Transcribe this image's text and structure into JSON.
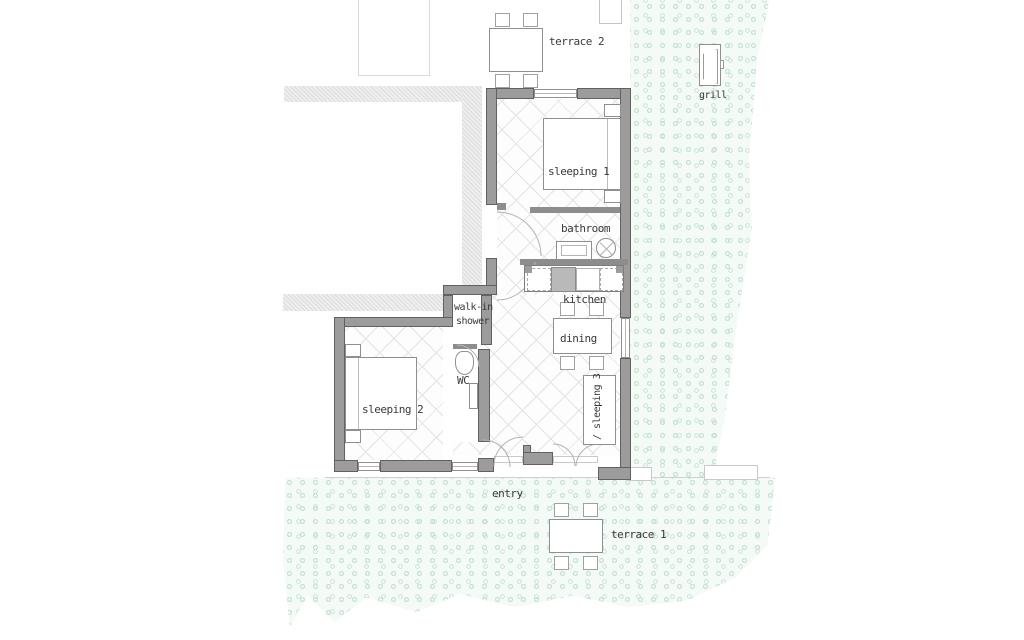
{
  "plan": {
    "rooms": {
      "sleeping1": "sleeping 1",
      "sleeping2": "sleeping 2",
      "sleeping3": "/ sleeping 3",
      "bathroom": "bathroom",
      "kitchen": "kitchen",
      "dining": "dining",
      "wc": "WC",
      "walkin_shower_line1": "walk-in",
      "walkin_shower_line2": "shower"
    },
    "outdoor": {
      "terrace1": "terrace 1",
      "terrace2": "terrace 2",
      "grill": "grill",
      "entry": "entry"
    },
    "colors": {
      "wall_fill": "#9c9c9c",
      "wall_outline": "#616161",
      "floor_hatch_line": "#e3e3e3",
      "existing_building_hatch": "#dcdcdc",
      "vegetation_ring": "#c3e0d1",
      "vegetation_background": "#f4faf6",
      "label_text": "#3a3a3a"
    }
  }
}
